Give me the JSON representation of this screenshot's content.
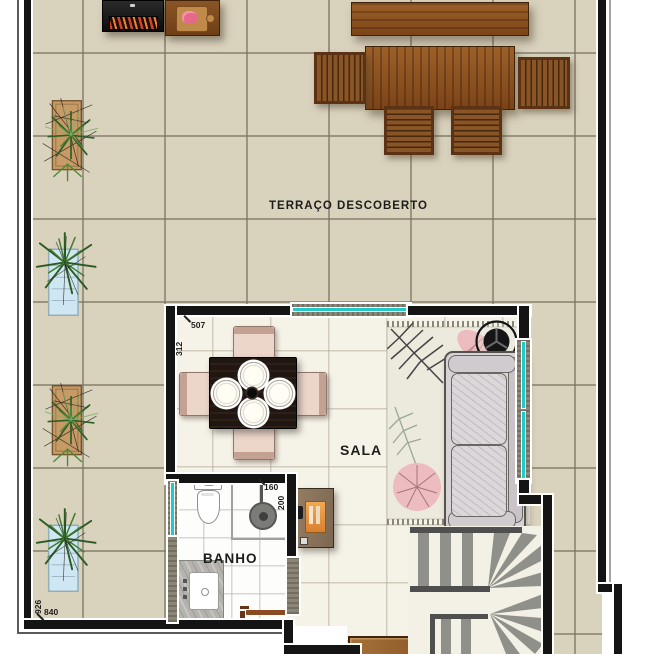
{
  "plan": {
    "type": "floor-plan",
    "labels": {
      "terrace": "TERRAÇO DESCOBERTO",
      "living_room": "SALA",
      "bathroom": "BANHO"
    },
    "dimensions": {
      "sala_width": "507",
      "sala_depth": "312",
      "shower_width": "160",
      "shower_depth": "200",
      "terrace_depth": "926",
      "terrace_width": "840"
    },
    "colors": {
      "wall": "#141414",
      "window_glass": "#23c8cb",
      "terrace_tile": "#d9d2bd",
      "interior_floor": "#f5f2e7",
      "bathroom_floor": "#fdfdfd",
      "wood": "#8a5526",
      "plant_green": "#3f7c2f"
    },
    "furniture_icons": [
      "bbq-grill-icon",
      "prep-table-icon",
      "outdoor-bench-icon",
      "outdoor-dining-table-icon",
      "outdoor-chair-icon",
      "planter-plant-icon",
      "dining-table-icon",
      "dining-chair-icon",
      "plate-icon",
      "sofa-icon",
      "rug-icon",
      "round-side-table-icon",
      "bar-cart-icon",
      "sideboard-icon",
      "staircase-icon",
      "toilet-icon",
      "shower-icon",
      "vanity-sink-icon",
      "door-icon",
      "window-icon"
    ]
  }
}
